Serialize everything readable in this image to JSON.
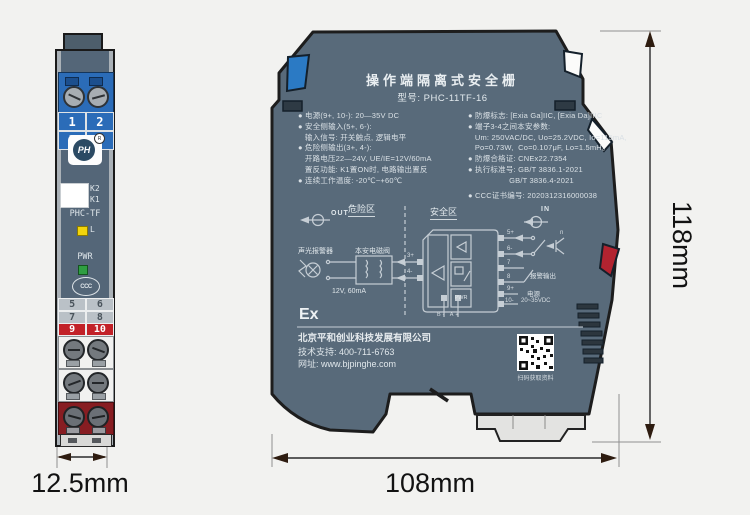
{
  "front": {
    "numbers_top": [
      "1",
      "2",
      "3",
      "4"
    ],
    "logo_text": "PH",
    "logo_reg": "R",
    "k2": "K2",
    "k1": "K1",
    "model": "PHC-TF",
    "led_l": "L",
    "pwr": "PWR",
    "ccc": "CCC",
    "numbers_bottom": [
      "5",
      "6",
      "7",
      "8",
      "9",
      "10"
    ]
  },
  "side": {
    "title": "操作端隔离式安全栅",
    "model_line": "型号: PHC-11TF-16",
    "specs_left": [
      "● 电源(9+, 10-): 20—35V DC",
      "● 安全侧输入(5+, 6-):",
      "   输入信号: 开关触点, 逻辑电平",
      "● 危险侧输出(3+, 4-):",
      "   开路电压22—24V, UE/IE=12V/60mA",
      "   置反功能: K1置ON时, 电路输出置反",
      "● 连续工作温度: -20℃~+60℃"
    ],
    "specs_right": [
      "● 防爆标志: [Exia Ga]IIC, [Exia Da]IIIC",
      "● 端子3-4之间本安参数:",
      "   Um: 250VAC/DC, Uo=25.2VDC, Io=115mA,",
      "   Po=0.73W,  Co=0.107μF, Lo=1.5mH。",
      "● 防爆合格证: CNEx22.7354",
      "● 执行标准号: GB/T 3836.1-2021",
      "                  GB/T 3836.4-2021",
      "● CCC证书编号: 2020312316000038"
    ],
    "diagram": {
      "out_label": "OUT",
      "in_label": "IN",
      "hazard_zone": "危险区",
      "safe_zone": "安全区",
      "alarm_device": "声光报警器",
      "solenoid_valve": "本安电磁阀",
      "load_rating": "12V, 60mA",
      "t3": "3+",
      "t4": "4-",
      "t5": "5+",
      "t6": "6-",
      "t7": "7",
      "t8": "8",
      "t9": "9+",
      "t10": "10-",
      "npn_label": "n",
      "alarm_output": "报警输出",
      "power_label": "电源",
      "power_range": "20~35VDC",
      "pwr_block": "PWR",
      "bus_pins": "B- A+"
    },
    "ex_mark": "Ex",
    "company": "北京平和创业科技发展有限公司",
    "support": "技术支持: 400-711-6763",
    "website": "网址: www.bjpinghe.com",
    "qr_caption": "扫码获取资料"
  },
  "dimensions": {
    "height": "118mm",
    "width": "108mm",
    "depth": "12.5mm"
  }
}
